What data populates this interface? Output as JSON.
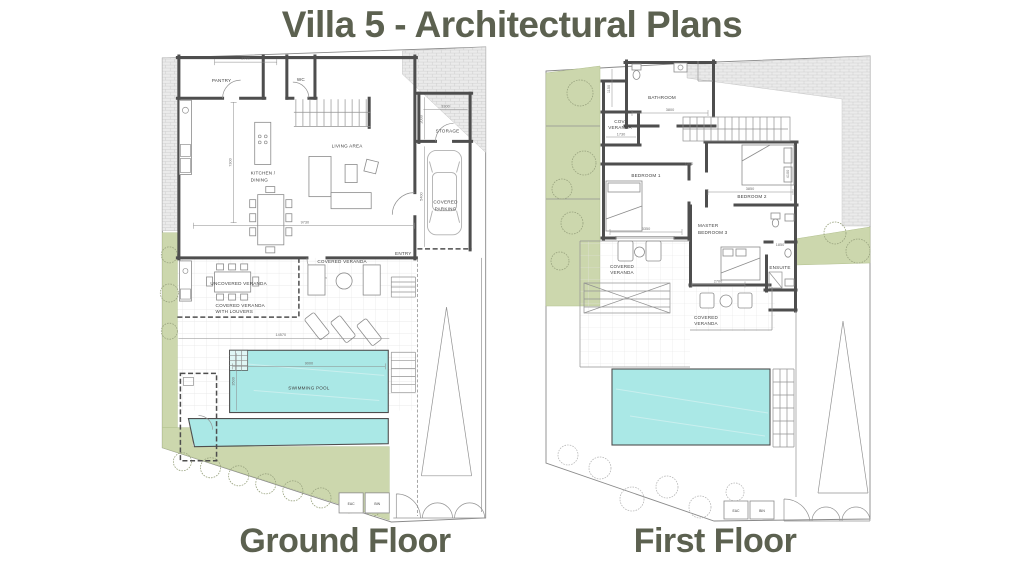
{
  "title": "Villa 5 - Architectural Plans",
  "colors": {
    "heading": "#5c6150",
    "pool": "#aae8e6",
    "landscape": "#ccd7ad",
    "wall": "#4e4e4e"
  },
  "ground_floor": {
    "caption": "Ground Floor",
    "labels": {
      "pantry": "PANTRY",
      "wc": "WC",
      "storage": "STORAGE",
      "living_area": "LIVING AREA",
      "kitchen_line1": "KITCHEN /",
      "kitchen_line2": "DINING",
      "parking_line1": "COVERED",
      "parking_line2": "PARKING",
      "entry": "ENTRY",
      "covered_veranda": "COVERED VERANDA",
      "uncovered_veranda": "UNCOVERED VERANDA",
      "louvered_line1": "COVERED VERANDA",
      "louvered_line2": "WITH LOUVERS",
      "swimming_pool": "SWIMMING POOL",
      "eac": "EAC",
      "bin": "BIN"
    },
    "dimensions": {
      "pantry_width": "2700",
      "kitchen_depth": "7300",
      "living_width": "9730",
      "storage_width": "3300",
      "storage_depth": "2000",
      "parking_depth": "5400",
      "terrace_width": "14570",
      "pool_length": "9000",
      "pool_width": "3500"
    }
  },
  "first_floor": {
    "caption": "First Floor",
    "labels": {
      "bathroom": "BATHROOM",
      "cov_veranda_line1": "COV.",
      "cov_veranda_line2": "VERANDA",
      "bedroom1": "BEDROOM 1",
      "bedroom2": "BEDROOM 2",
      "master_line1": "MASTER",
      "master_line2": "BEDROOM 3",
      "ensuite": "ENSUITE",
      "veranda_left_line1": "COVERED",
      "veranda_left_line2": "VERANDA",
      "veranda_bottom_line1": "COVERED",
      "veranda_bottom_line2": "VERANDA",
      "eac": "EAC",
      "bin": "BIN"
    },
    "dimensions": {
      "bathroom_width": "3800",
      "shaft_depth": "1150",
      "cov_veranda_width": "1730",
      "corridor": "1200",
      "bedroom1_width": "3350",
      "bedroom2_width": "3850",
      "bedroom2_depth": "4100",
      "ensuite_width": "1850",
      "veranda_width": "2700"
    }
  }
}
